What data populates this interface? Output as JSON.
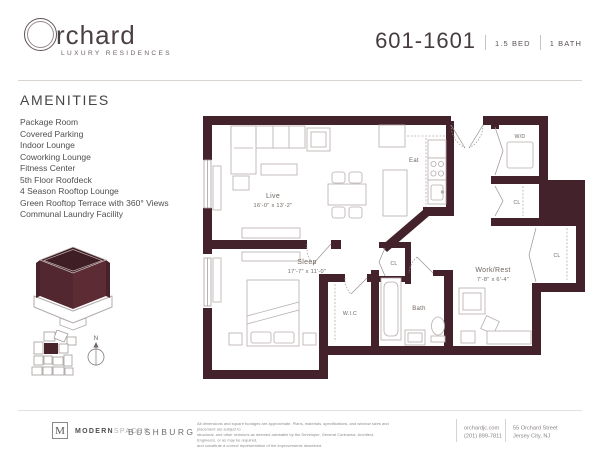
{
  "header": {
    "brand_word": "rchard",
    "tagline": "LUXURY RESIDENCES",
    "unit_number": "601-1601",
    "bed": "1.5 BED",
    "bath": "1 BATH"
  },
  "amenities": {
    "title": "AMENITIES",
    "items": [
      "Package Room",
      "Covered Parking",
      "Indoor Lounge",
      "Coworking Lounge",
      "Fitness Center",
      "5th Floor Roofdeck",
      "4 Season Rooftop Lounge",
      "Green Rooftop Terrace with 360° Views",
      "Communal Laundry Facility"
    ]
  },
  "floorplan": {
    "live_label": "Live",
    "live_dims": "16'-0\" x 13'-2\"",
    "eat_label": "Eat",
    "sleep_label": "Sleep",
    "sleep_dims": "17'-7\" x 11'-0\"",
    "work_rest_label": "Work/Rest",
    "work_rest_dims": "7'-8\" x 6'-4\"",
    "bath_label": "Bath",
    "wic_label": "W.I.C",
    "wd_label": "W/D",
    "cl_label": "CL",
    "compass_label": "N"
  },
  "footer": {
    "monogram": "M",
    "brokerage_bold": "MODERN",
    "brokerage_light": "SPACES",
    "developer": "BUSHBURG",
    "disclaimer_line1": "All dimensions and square footages are approximate. Plans, materials, specifications, and window sizes and placement are subject to",
    "disclaimer_line2": "structural, and other revisions as deemed advisable by the Developer, General Contractor, Architect, Engineers, or as may be required,",
    "disclaimer_line3": "and constitute a correct representation of the improvements described.",
    "website": "orchardjc.com",
    "phone": "(201) 899-7811",
    "address_line1": "55 Orchard Street",
    "address_line2": "Jersey City, NJ"
  },
  "colors": {
    "wall": "#44222b",
    "building_dark": "#3f1e26",
    "building_left": "#522730",
    "building_right": "#5c2b34",
    "furniture_line": "#b7aeae"
  }
}
